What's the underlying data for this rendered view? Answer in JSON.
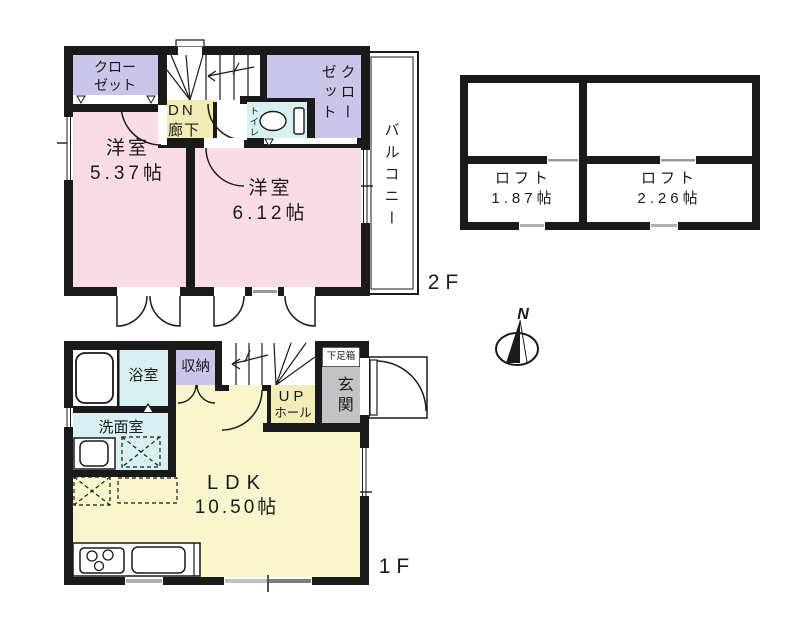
{
  "plan": {
    "floor2": {
      "label": "2F",
      "closet_left": "クローゼット",
      "dn": "DN",
      "hallway": "廊下",
      "toilet": "トイレ",
      "closet_right": "クローゼット",
      "balcony": "バルコニー",
      "room1_name": "洋室",
      "room1_size": "5.37帖",
      "room2_name": "洋室",
      "room2_size": "6.12帖"
    },
    "loft": {
      "left_name": "ロフト",
      "left_size": "1.87帖",
      "right_name": "ロフト",
      "right_size": "2.26帖"
    },
    "floor1": {
      "label": "1F",
      "bathroom": "浴室",
      "washroom": "洗面室",
      "storage": "収納",
      "up": "UP",
      "hall": "ホール",
      "shoe_box": "下足箱",
      "entrance": "玄関",
      "ldk_name": "LDK",
      "ldk_size": "10.50帖"
    },
    "compass": {
      "north": "N"
    }
  },
  "colors": {
    "wall": "#1a1a1a",
    "room_pink": "#f9dce6",
    "closet_purple": "#c9c6e9",
    "corridor_yellow": "#f1ecb5",
    "ldk_yellow": "#f9f5cd",
    "wet_cyan": "#d9f0f3",
    "entrance_gray": "#c3c3c5",
    "background": "#ffffff"
  }
}
